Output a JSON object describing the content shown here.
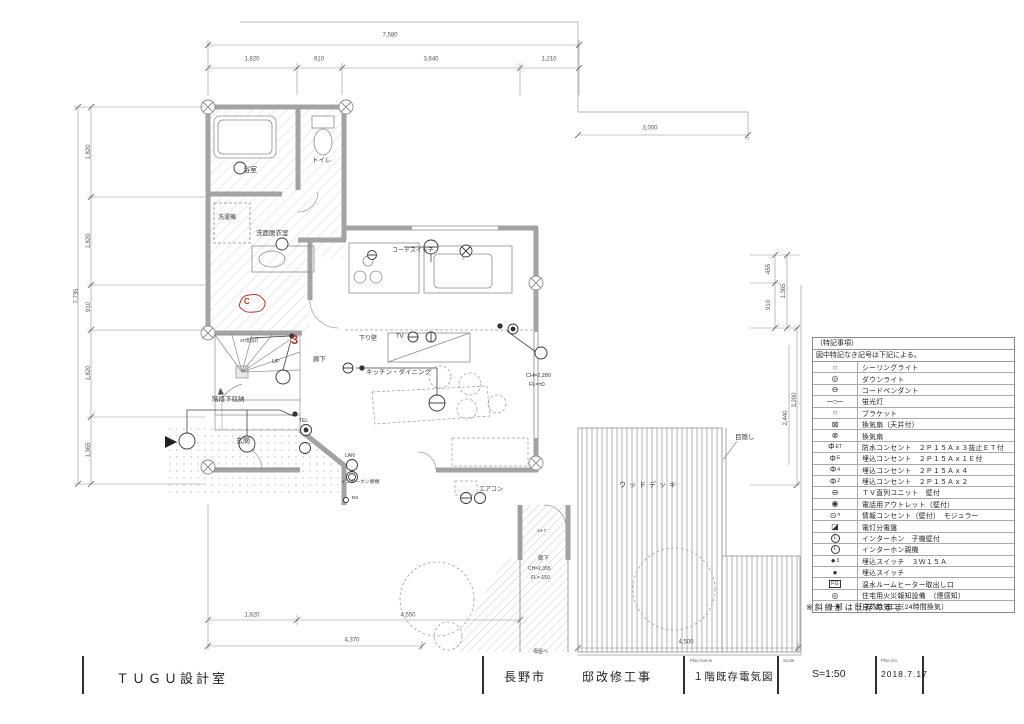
{
  "drawing": {
    "note_existing": "※斜線部は既存のまま",
    "annotations": {
      "revision_mark": "C",
      "three_way_switch": "3"
    }
  },
  "legend": {
    "header1": "（特記事項）",
    "header2": "図中特記なき記号は下記による。",
    "rows": [
      {
        "sym": "○",
        "label": "シーリングライト"
      },
      {
        "sym": "◎",
        "label": "ダウンライト"
      },
      {
        "sym": "⊖",
        "label": "コードペンダント"
      },
      {
        "sym": "─○─",
        "label": "蛍光灯"
      },
      {
        "sym": "○",
        "label": "ブラケット"
      },
      {
        "sym": "⊠",
        "label": "換気扇（天井付）"
      },
      {
        "sym": "⊗",
        "label": "換気扇"
      },
      {
        "sym": "Φ",
        "sfx": "ET",
        "label": "防水コンセント　２Ｐ１５Ａｘ３抜止ＥＴ付"
      },
      {
        "sym": "Φ",
        "sfx": "E",
        "label": "埋込コンセント　２Ｐ１５Ａｘ１Ｅ付"
      },
      {
        "sym": "Φ",
        "sfx": "4",
        "label": "埋込コンセント　２Ｐ１５Ａｘ４"
      },
      {
        "sym": "Φ",
        "sfx": "2",
        "label": "埋込コンセント　２Ｐ１５Ａｘ２"
      },
      {
        "sym": "⊖",
        "label": "ＴＶ直列ユニット　壁付"
      },
      {
        "sym": "◉",
        "label": "電話用アウトレット（壁付）"
      },
      {
        "sym": "⊙",
        "sfx": "n",
        "label": "情報コンセント（壁付）　モジュラー"
      },
      {
        "sym": "◪",
        "label": "電灯分電盤"
      },
      {
        "sym": "L",
        "circ": 1,
        "label": "インターホン　子機壁付"
      },
      {
        "sym": "L",
        "circ": 2,
        "label": "インターホン親機"
      },
      {
        "sym": "●",
        "sfx": "3",
        "label": "埋込スイッチ　３Ｗ１５Ａ"
      },
      {
        "sym": "●",
        "label": "埋込スイッチ"
      },
      {
        "sym": "FG",
        "box": 1,
        "label": "温水ルームヒーター取出し口"
      },
      {
        "sym": "◎",
        "label": "住宅用火災報知設備　（煙感知）"
      },
      {
        "sym": "─●",
        "label": "自然給気口（24時間換気）"
      }
    ]
  },
  "plan_labels": [
    {
      "t": "浴室",
      "x": 243,
      "y": 167,
      "s": 7
    },
    {
      "t": "トイレ",
      "x": 312,
      "y": 158,
      "s": 6.5
    },
    {
      "t": "洗濯機",
      "x": 218,
      "y": 215,
      "s": 6
    },
    {
      "t": "洗面脱衣室",
      "x": 256,
      "y": 231,
      "s": 6.5
    },
    {
      "t": "コードスイッチ",
      "x": 392,
      "y": 248,
      "s": 6
    },
    {
      "t": "下り壁",
      "x": 359,
      "y": 336,
      "s": 6
    },
    {
      "t": "TV",
      "x": 396,
      "y": 334,
      "s": 6
    },
    {
      "t": "キッチン・ダイニング",
      "x": 366,
      "y": 370,
      "s": 6.5
    },
    {
      "t": "廊下",
      "x": 313,
      "y": 357,
      "s": 6.5
    },
    {
      "t": "UP",
      "x": 272,
      "y": 360,
      "s": 5.5
    },
    {
      "t": "2F階段灯",
      "x": 240,
      "y": 339,
      "s": 4.5
    },
    {
      "t": "階段下収納",
      "x": 212,
      "y": 397,
      "s": 6.5
    },
    {
      "t": "玄関",
      "x": 236,
      "y": 438,
      "s": 7
    },
    {
      "t": "TEL",
      "x": 299,
      "y": 419,
      "s": 5
    },
    {
      "t": "LAN",
      "x": 345,
      "y": 454,
      "s": 5
    },
    {
      "t": "インターホン親機",
      "x": 341,
      "y": 481,
      "s": 4.8
    },
    {
      "t": "BS",
      "x": 352,
      "y": 497,
      "s": 4.8
    },
    {
      "t": "エアコン",
      "x": 479,
      "y": 487,
      "s": 6
    },
    {
      "t": "ウッドデッキ",
      "x": 619,
      "y": 482,
      "s": 7,
      "ls": 3
    },
    {
      "t": "目隠し",
      "x": 735,
      "y": 435,
      "s": 6.5
    },
    {
      "t": "CH=2,280",
      "x": 526,
      "y": 374,
      "s": 5.5
    },
    {
      "t": "FL=±0",
      "x": 529,
      "y": 383,
      "s": 5.5
    },
    {
      "t": "14-7",
      "x": 537,
      "y": 529,
      "s": 4.5
    },
    {
      "t": "廊下",
      "x": 538,
      "y": 557,
      "s": 5.5
    },
    {
      "t": "CH=2,355",
      "x": 528,
      "y": 567,
      "s": 5
    },
    {
      "t": "FL=-150",
      "x": 531,
      "y": 576,
      "s": 5
    },
    {
      "t": "母屋へ",
      "x": 533,
      "y": 650,
      "s": 5
    },
    {
      "t": "C",
      "x": 244,
      "y": 298,
      "s": 8,
      "c": 1
    },
    {
      "t": "3",
      "x": 291,
      "y": 333,
      "s": 13,
      "c": 1
    }
  ],
  "dim_labels": [
    {
      "t": "7,580",
      "x": 390,
      "y": 36
    },
    {
      "t": "1,820",
      "x": 252,
      "y": 60
    },
    {
      "t": "910",
      "x": 319,
      "y": 60
    },
    {
      "t": "3,640",
      "x": 431,
      "y": 60
    },
    {
      "t": "1,210",
      "x": 549,
      "y": 60
    },
    {
      "t": "3,000",
      "x": 650,
      "y": 129
    },
    {
      "t": "7,735",
      "x": 77,
      "y": 296,
      "r": 1
    },
    {
      "t": "1,820",
      "x": 89,
      "y": 152,
      "r": 1
    },
    {
      "t": "1,820",
      "x": 89,
      "y": 241,
      "r": 1
    },
    {
      "t": "910",
      "x": 89,
      "y": 307,
      "r": 1
    },
    {
      "t": "1,820",
      "x": 89,
      "y": 373,
      "r": 1
    },
    {
      "t": "1,365",
      "x": 89,
      "y": 450,
      "r": 1
    },
    {
      "t": "455",
      "x": 769,
      "y": 269,
      "r": 1
    },
    {
      "t": "910",
      "x": 769,
      "y": 305,
      "r": 1
    },
    {
      "t": "1,365",
      "x": 784,
      "y": 291,
      "r": 1
    },
    {
      "t": "3,200",
      "x": 795,
      "y": 400,
      "r": 1
    },
    {
      "t": "2,440",
      "x": 786,
      "y": 418,
      "r": 1
    },
    {
      "t": "1,820",
      "x": 252,
      "y": 616
    },
    {
      "t": "4,550",
      "x": 408,
      "y": 616
    },
    {
      "t": "4,370",
      "x": 352,
      "y": 641
    },
    {
      "t": "4,500",
      "x": 686,
      "y": 643
    }
  ],
  "title_block": {
    "firm": "ＴＵＧＵ設計室",
    "city": "長野市",
    "project": "邸改修工事",
    "plan_name_label": "Plan Name",
    "plan_name": "１階既存電気図",
    "scale_label": "Scale",
    "scale": "S=1:50",
    "plan_no_label": "Plan No.",
    "date": "2018.7.17"
  }
}
